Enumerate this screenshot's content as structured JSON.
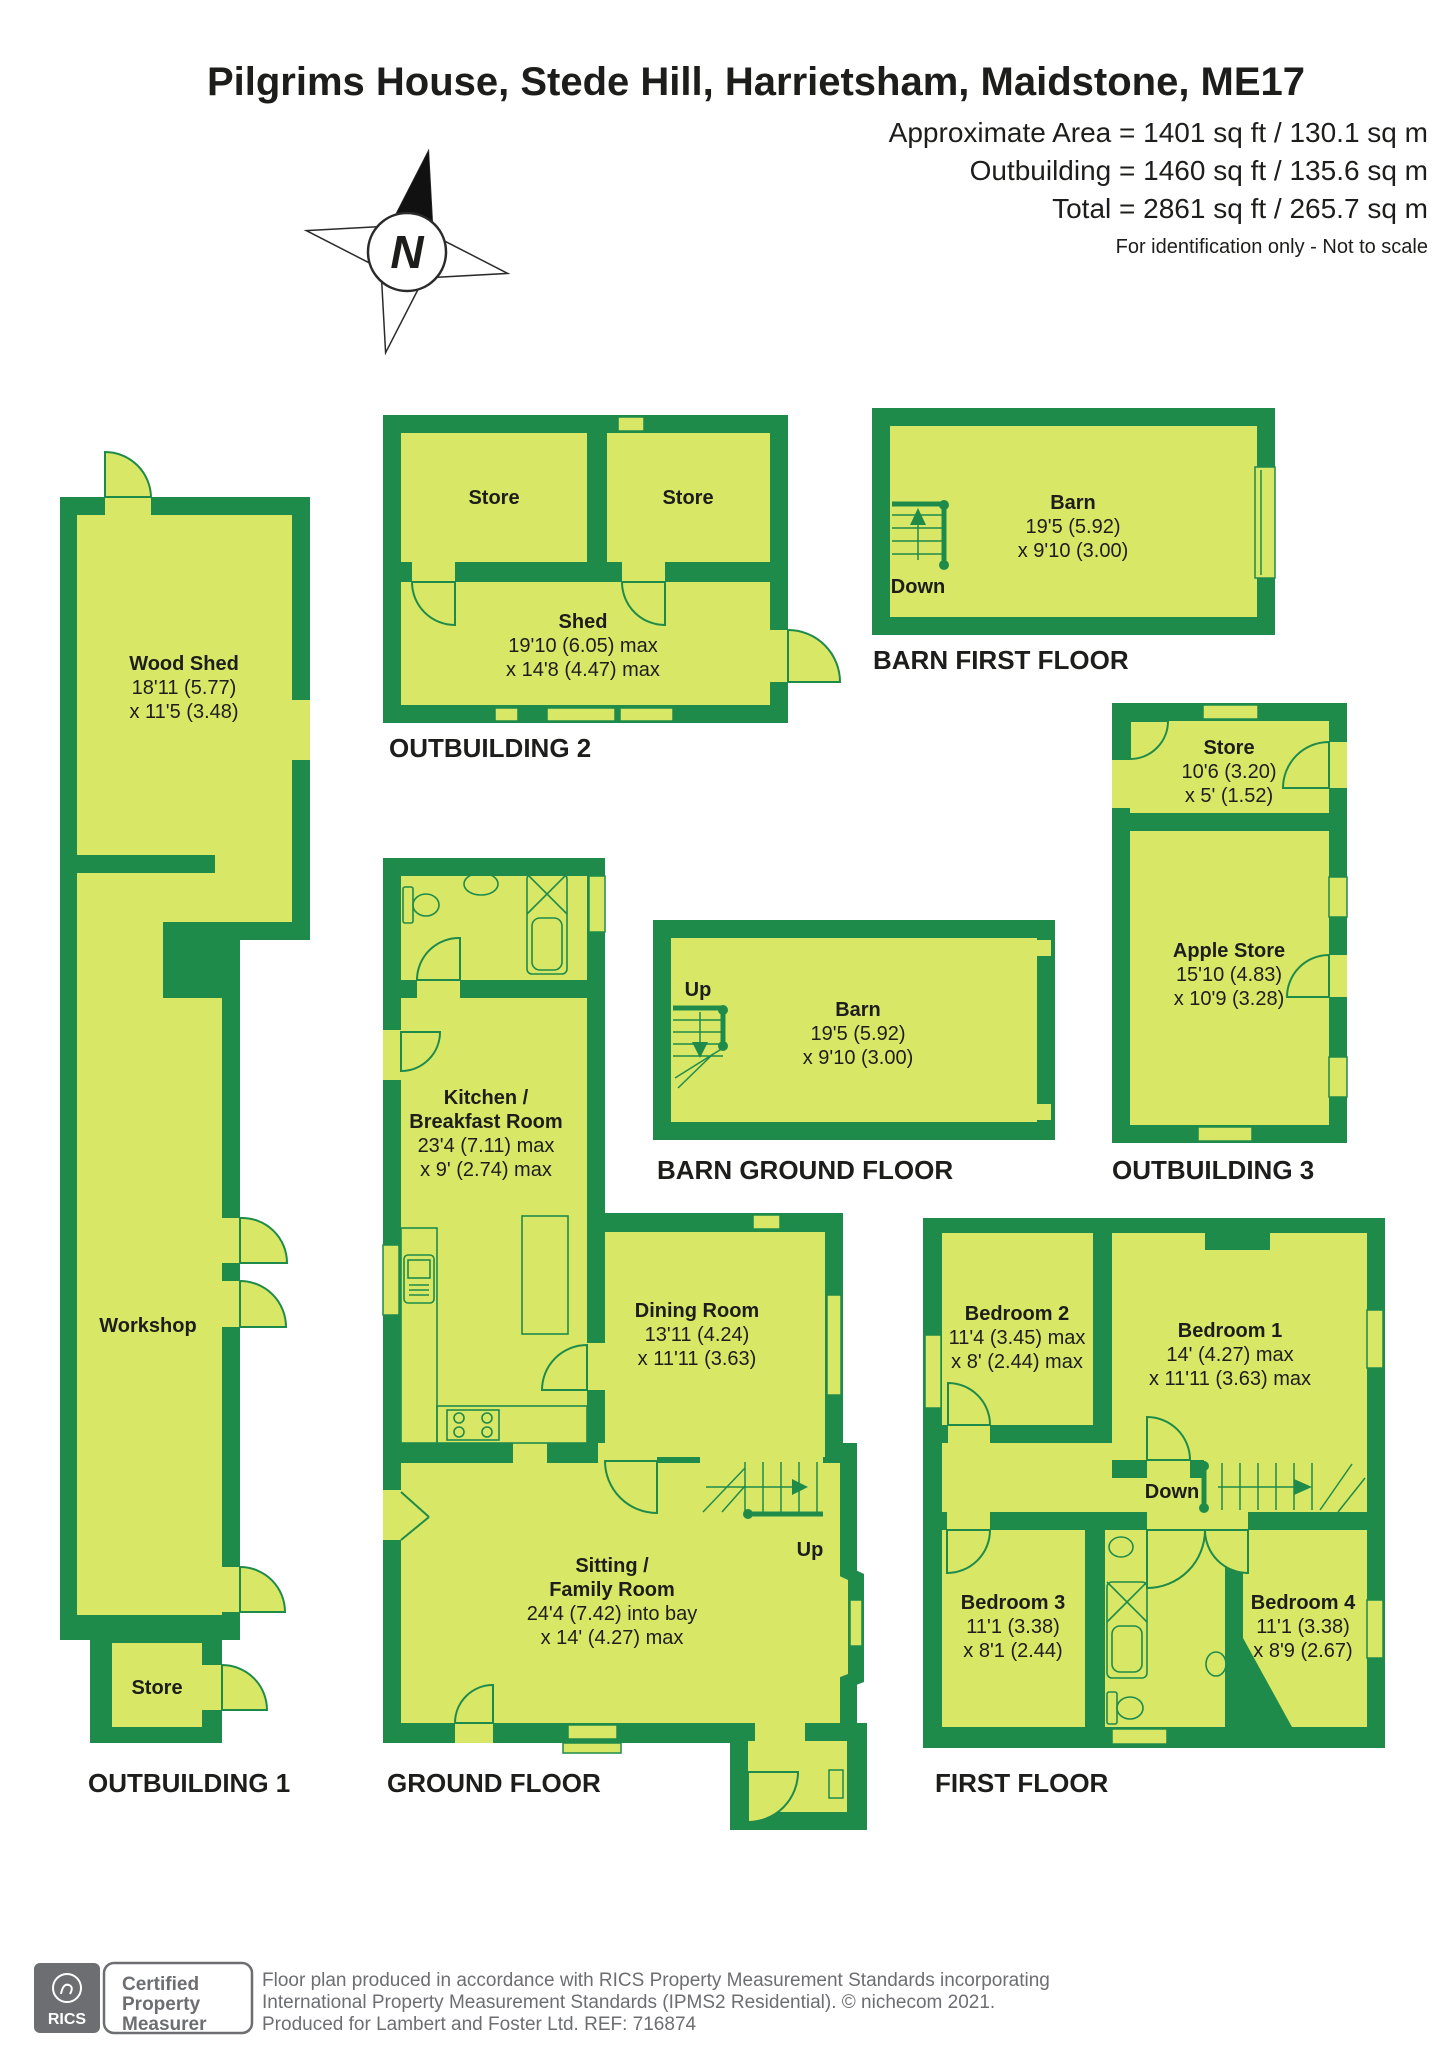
{
  "header": {
    "title": "Pilgrims House, Stede Hill, Harrietsham, Maidstone, ME17",
    "area_lines": [
      "Approximate Area = 1401 sq ft / 130.1 sq m",
      "Outbuilding = 1460 sq ft / 135.6 sq m",
      "Total = 2861 sq ft / 265.7 sq m"
    ],
    "disclaimer": "For identification only - Not to scale",
    "compass_letter": "N"
  },
  "sections": {
    "outbuilding1": {
      "label": "OUTBUILDING 1",
      "wood_shed": {
        "name": "Wood Shed",
        "dims": [
          "18'11 (5.77)",
          "x 11'5 (3.48)"
        ]
      },
      "workshop": {
        "name": "Workshop"
      },
      "store": {
        "name": "Store"
      }
    },
    "outbuilding2": {
      "label": "OUTBUILDING 2",
      "store1": {
        "name": "Store"
      },
      "store2": {
        "name": "Store"
      },
      "shed": {
        "name": "Shed",
        "dims": [
          "19'10 (6.05) max",
          "x 14'8 (4.47) max"
        ]
      }
    },
    "outbuilding3": {
      "label": "OUTBUILDING 3",
      "store": {
        "name": "Store",
        "dims": [
          "10'6 (3.20)",
          "x 5' (1.52)"
        ]
      },
      "apple_store": {
        "name": "Apple Store",
        "dims": [
          "15'10 (4.83)",
          "x 10'9 (3.28)"
        ]
      }
    },
    "barn_first": {
      "label": "BARN FIRST FLOOR",
      "stairs_label": "Down",
      "room": {
        "name": "Barn",
        "dims": [
          "19'5 (5.92)",
          "x 9'10 (3.00)"
        ]
      }
    },
    "barn_ground": {
      "label": "BARN GROUND FLOOR",
      "stairs_label": "Up",
      "room": {
        "name": "Barn",
        "dims": [
          "19'5 (5.92)",
          "x 9'10 (3.00)"
        ]
      }
    },
    "ground_floor": {
      "label": "GROUND FLOOR",
      "stairs_label": "Up",
      "kitchen": {
        "name1": "Kitchen /",
        "name2": "Breakfast Room",
        "dims": [
          "23'4 (7.11) max",
          "x 9' (2.74) max"
        ]
      },
      "dining": {
        "name": "Dining Room",
        "dims": [
          "13'11 (4.24)",
          "x 11'11 (3.63)"
        ]
      },
      "sitting": {
        "name1": "Sitting /",
        "name2": "Family Room",
        "dims": [
          "24'4 (7.42) into bay",
          "x 14' (4.27) max"
        ]
      }
    },
    "first_floor": {
      "label": "FIRST FLOOR",
      "stairs_label": "Down",
      "bedroom1": {
        "name": "Bedroom 1",
        "dims": [
          "14' (4.27) max",
          "x 11'11 (3.63) max"
        ]
      },
      "bedroom2": {
        "name": "Bedroom 2",
        "dims": [
          "11'4 (3.45) max",
          "x 8' (2.44) max"
        ]
      },
      "bedroom3": {
        "name": "Bedroom 3",
        "dims": [
          "11'1 (3.38)",
          "x 8'1 (2.44)"
        ]
      },
      "bedroom4": {
        "name": "Bedroom 4",
        "dims": [
          "11'1 (3.38)",
          "x 8'9 (2.67)"
        ]
      }
    }
  },
  "footer": {
    "logo_text": "RICS",
    "badge_lines": [
      "Certified",
      "Property",
      "Measurer"
    ],
    "text_lines": [
      "Floor plan produced in accordance with RICS Property Measurement Standards incorporating",
      "International Property Measurement Standards (IPMS2 Residential).  © nichecom 2021.",
      "Produced for Lambert and Foster Ltd.  REF: 716874"
    ]
  },
  "colors": {
    "wall_green": "#1f8b4b",
    "room_fill": "#d9e766",
    "text": "#1d1d1b",
    "footer_gray": "#6d6e71"
  }
}
